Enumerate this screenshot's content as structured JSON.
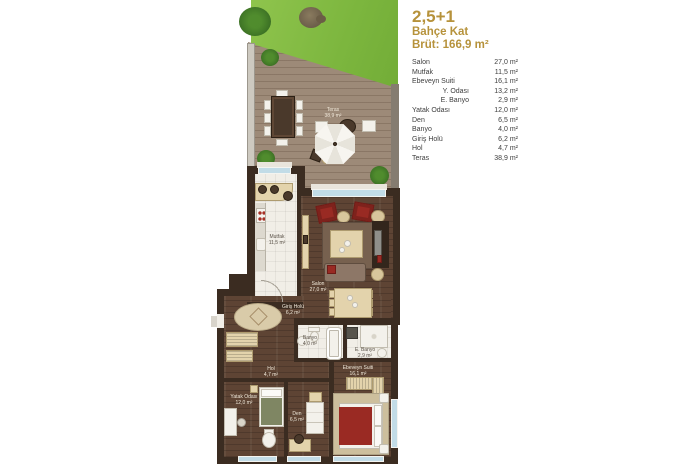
{
  "legend": {
    "title": "2,5+1",
    "subtitle": "Bahçe Kat",
    "gross": "Brüt: 166,9 m²",
    "rows": [
      {
        "label": "Salon",
        "area": "27,0 m²",
        "indent": false
      },
      {
        "label": "Mutfak",
        "area": "11,5 m²",
        "indent": false
      },
      {
        "label": "Ebeveyn Suiti",
        "area": "16,1 m²",
        "indent": false
      },
      {
        "label": "Y. Odası",
        "area": "13,2 m²",
        "indent": true
      },
      {
        "label": "E. Banyo",
        "area": "2,9 m²",
        "indent": true
      },
      {
        "label": "Yatak Odası",
        "area": "12,0 m²",
        "indent": false
      },
      {
        "label": "Den",
        "area": "6,5 m²",
        "indent": false
      },
      {
        "label": "Banyo",
        "area": "4,0 m²",
        "indent": false
      },
      {
        "label": "Giriş Holü",
        "area": "6,2 m²",
        "indent": false
      },
      {
        "label": "Hol",
        "area": "4,7 m²",
        "indent": false
      },
      {
        "label": "Teras",
        "area": "38,9 m²",
        "indent": false
      }
    ]
  },
  "plan": {
    "rooms": {
      "teras": {
        "name": "Teras",
        "area": "38,9 m²"
      },
      "mutfak": {
        "name": "Mutfak",
        "area": "11,5 m²"
      },
      "salon": {
        "name": "Salon",
        "area": "27,0 m²"
      },
      "giris": {
        "name": "Giriş Holü",
        "area": "6,2 m²"
      },
      "banyo": {
        "name": "Banyo",
        "area": "4,0 m²"
      },
      "e_banyo": {
        "name": "E. Banyo",
        "area": "2,9 m²"
      },
      "hol": {
        "name": "Hol",
        "area": "4,7 m²"
      },
      "yatak": {
        "name": "Yatak Odası",
        "area": "12,0 m²"
      },
      "den": {
        "name": "Den",
        "area": "6,5 m²"
      },
      "ebeveyn": {
        "name": "Ebeveyn Suiti",
        "area": "16,1 m²"
      }
    }
  },
  "colors": {
    "accent_gold": "#B6923B",
    "wall": "#3B2C21",
    "grass": "#7CB63E",
    "deck": "#9D8A78",
    "wood_floor": "#5E4434",
    "window_blue": "#C2DCE7",
    "furniture_red": "#992A23"
  }
}
